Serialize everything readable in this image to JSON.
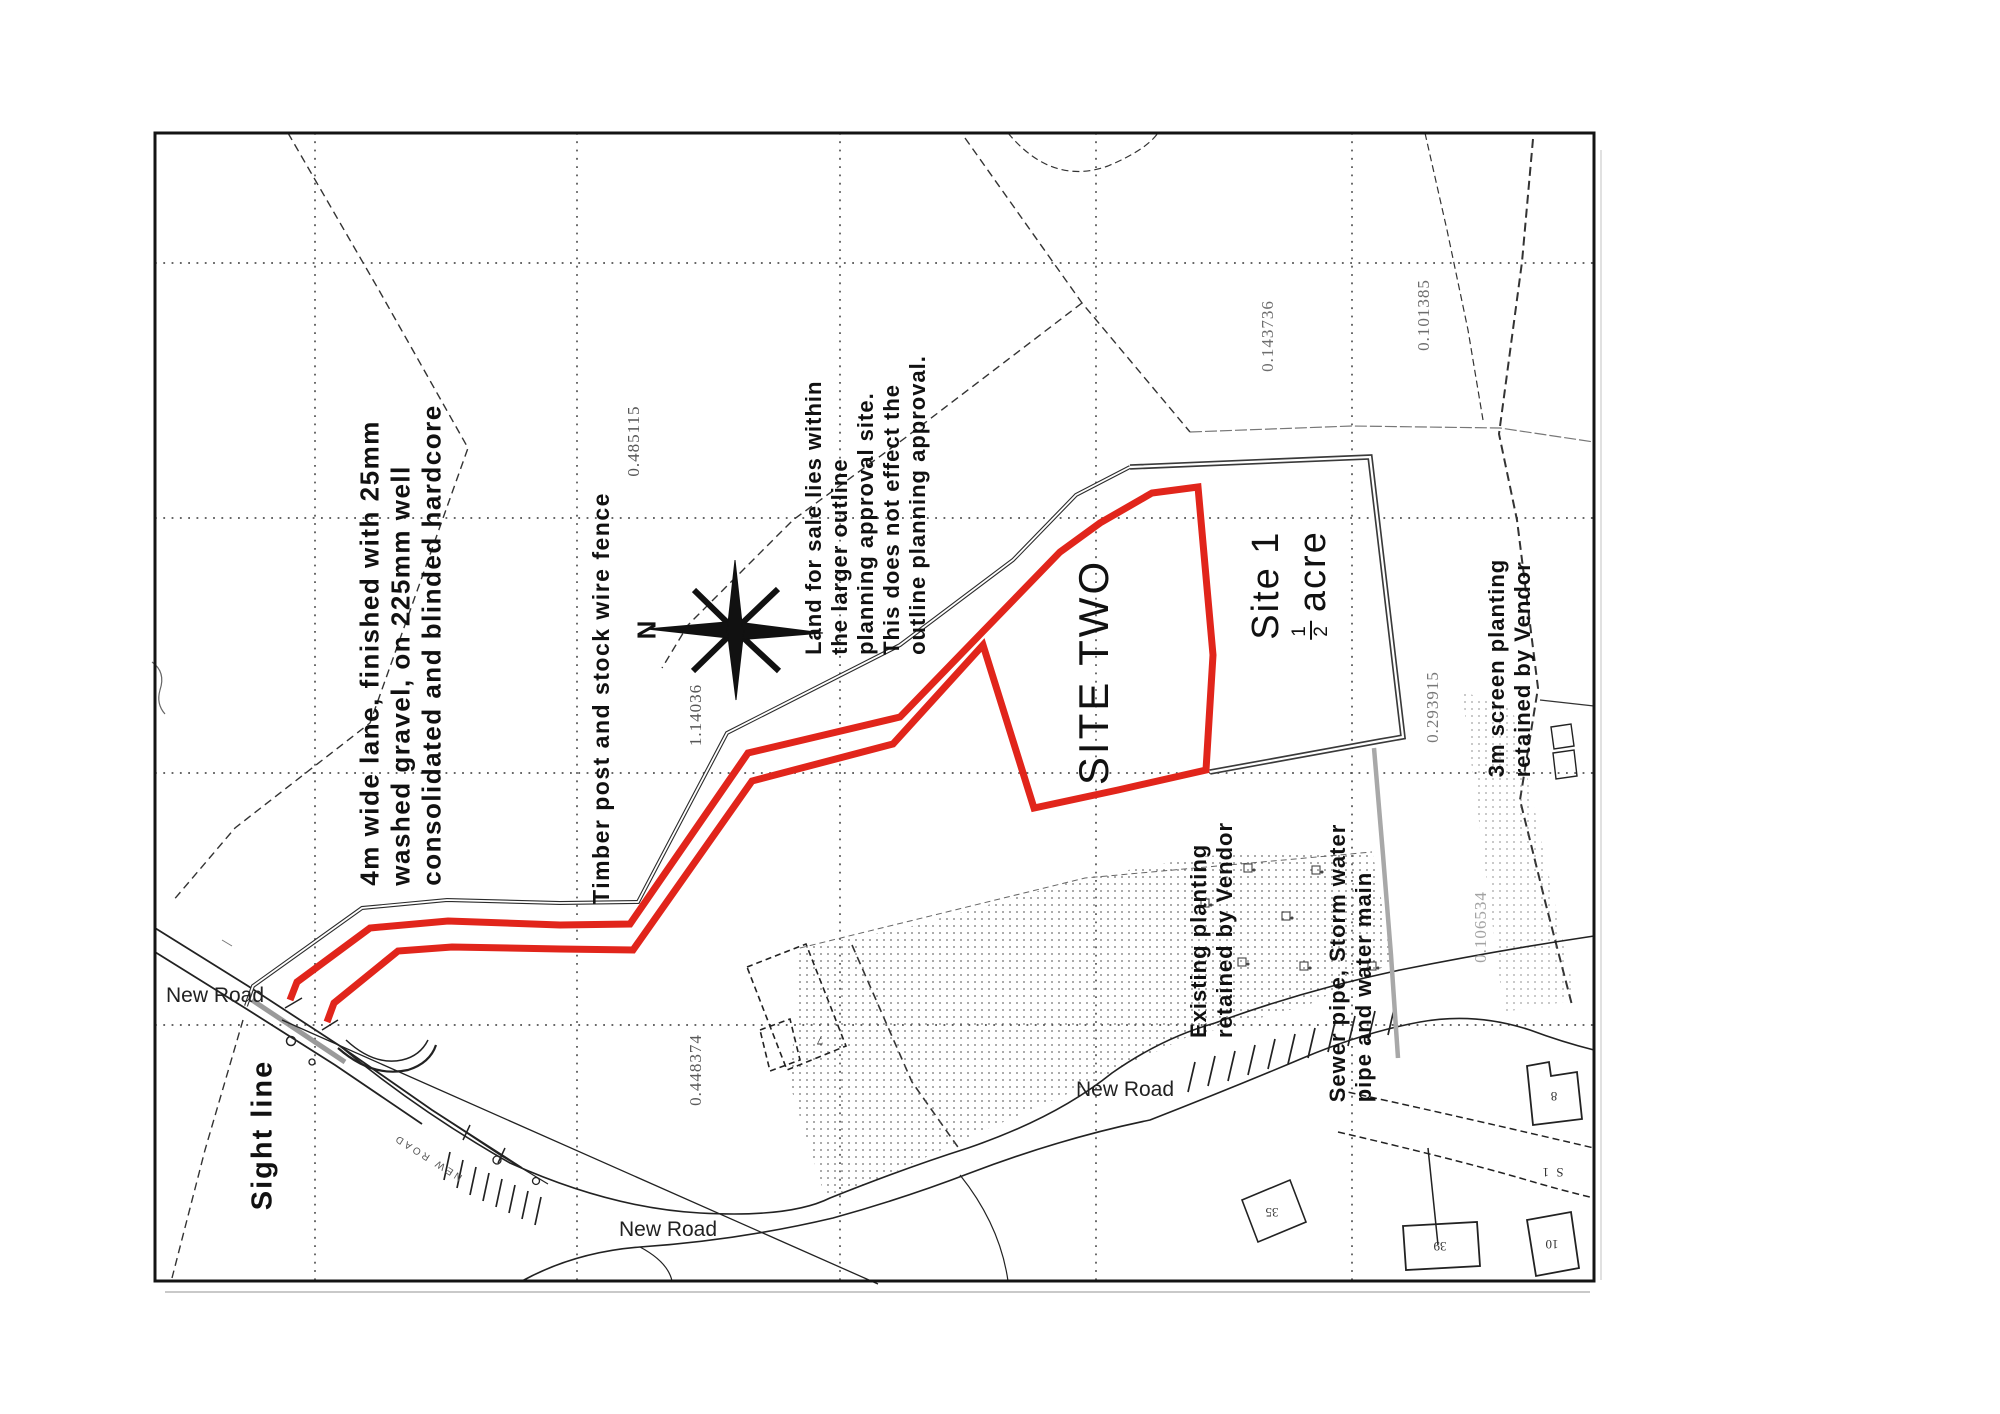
{
  "colors": {
    "accent_red": "#e1251b",
    "line_dark": "#222222",
    "boundary_dark": "#3a3a3a",
    "sewer_gray": "#a8a8a8",
    "grid": "#3f3f3f"
  },
  "annotations": {
    "lane_note": {
      "lines": [
        "4m wide lane, finished with 25mm",
        "washed gravel, on 225mm well",
        "consolidated and blinded hardcore"
      ]
    },
    "fence_note": "Timber post and stock wire fence",
    "sale_note": {
      "lines": [
        "Land for sale lies within",
        "the larger outline",
        "planning approval site.",
        "This does not effect the",
        "outline planning approval."
      ]
    },
    "site_two": "SITE TWO",
    "site_one": {
      "line1": "Site 1",
      "frac_num": "1",
      "frac_den": "2",
      "acre_word": "acre"
    },
    "screen_planting": {
      "lines": [
        "3m screen planting",
        "retained by Vendor"
      ]
    },
    "existing_planting": {
      "lines": [
        "Existing planting",
        "retained by Vendor"
      ]
    },
    "sewer_note": {
      "lines": [
        "Sewer pipe, Storm water",
        "pipe and water main"
      ]
    },
    "sight_line": "Sight line",
    "compass_n": "N",
    "road_labels": [
      {
        "text": "New Road"
      },
      {
        "text": "New Road"
      },
      {
        "text": "New Road"
      }
    ],
    "road_name_small": "NEW ROAD",
    "corner_text": "S 1"
  },
  "parcel_numbers": [
    {
      "value": "0.485115"
    },
    {
      "value": "1.14036"
    },
    {
      "value": "0.143736"
    },
    {
      "value": "0.101385"
    },
    {
      "value": "0.293915"
    },
    {
      "value": "0.448374"
    },
    {
      "value": "0.106534"
    }
  ],
  "building_numbers": [
    {
      "value": "7"
    },
    {
      "value": "35"
    },
    {
      "value": "8"
    },
    {
      "value": "39"
    },
    {
      "value": "10"
    }
  ]
}
